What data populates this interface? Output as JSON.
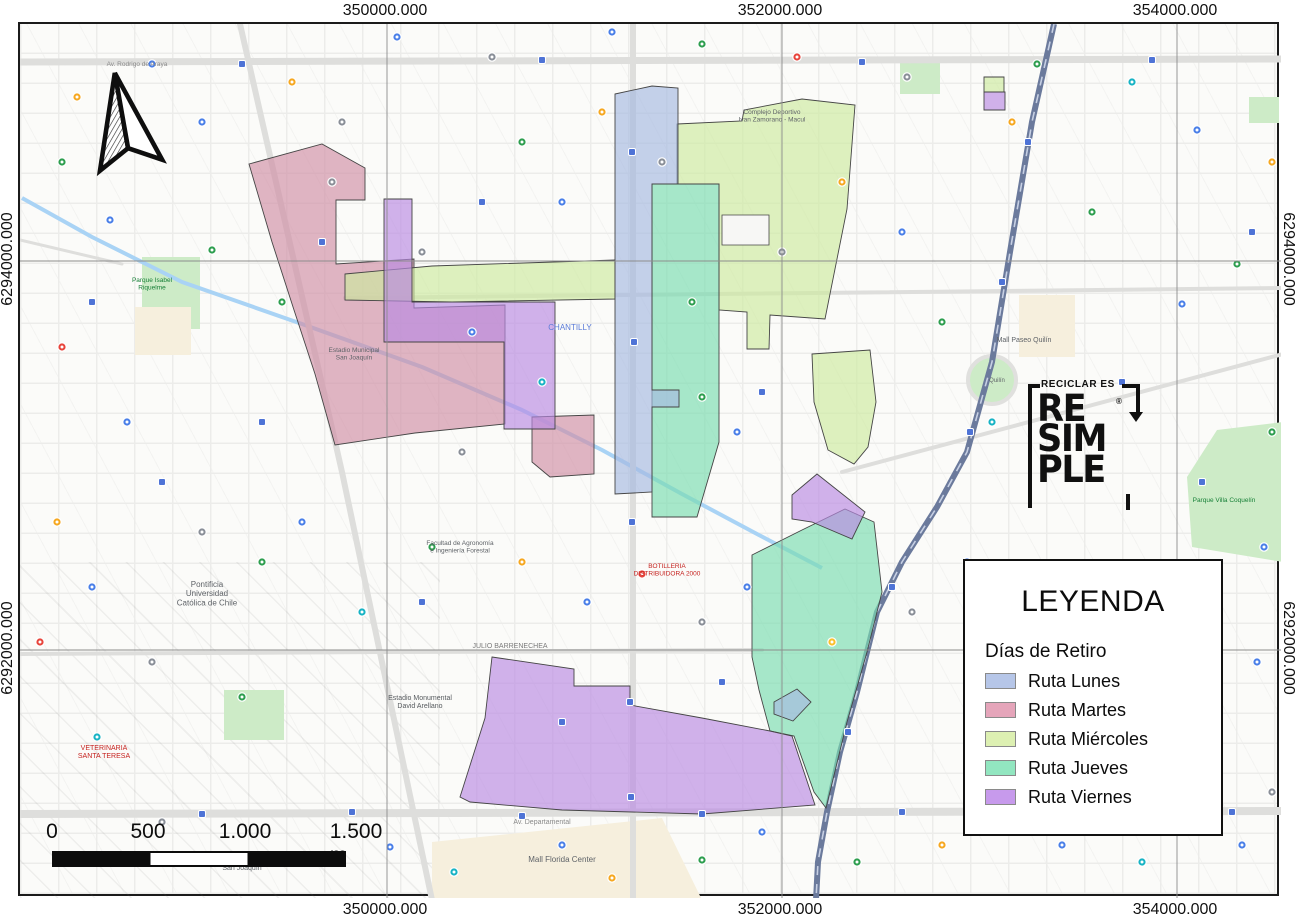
{
  "grid": {
    "x_ticks": [
      "350000.000",
      "352000.000",
      "354000.000"
    ],
    "y_ticks": [
      "6294000.000",
      "6292000.000"
    ]
  },
  "scalebar": {
    "labels": [
      "0",
      "500",
      "1.000",
      "1.500 m"
    ]
  },
  "legend": {
    "title": "LEYENDA",
    "subtitle": "Días de Retiro"
  },
  "logo": {
    "tagline": "RECICLAR ES",
    "lines": [
      "RE",
      "SIM",
      "PLE"
    ],
    "registered": "®"
  },
  "routes": [
    {
      "name": "Ruta Lunes",
      "legend_color": "#b6c6e8",
      "map_fill": "#a6b9e0",
      "polys": [
        "613,92 650,84 676,86 676,182 650,182 650,388 677,388 677,405 650,405 650,490 613,492",
        "772,700 795,687 809,700 791,719 772,712"
      ]
    },
    {
      "name": "Ruta Martes",
      "legend_color": "#e5a5ba",
      "map_fill": "#d08ea6",
      "polys": [
        "247,162 320,142 363,166 363,198 334,198 334,262 412,257 412,306 503,303 503,422 413,431 333,443 313,372 292,308 270,240",
        "530,415 592,413 592,472 548,475 530,460"
      ]
    },
    {
      "name": "Ruta Miércoles",
      "legend_color": "#ddf0b2",
      "map_fill": "#cde9a0",
      "polys": [
        "343,272 430,264 613,258 613,297 450,300 343,298",
        "675,122 740,119 742,108 800,97 853,103 845,207 837,247 823,317 768,313 767,347 745,347 745,310 717,308 717,182 675,182",
        "810,352 868,348 874,400 866,445 852,462 826,448 812,400",
        "982,75 1002,75 1002,90 982,90"
      ],
      "holes": [
        "720,213 767,213 767,243 720,243"
      ]
    },
    {
      "name": "Ruta Jueves",
      "legend_color": "#92e6c0",
      "map_fill": "#79dcb0",
      "polys": [
        "650,182 717,182 717,440 695,515 650,515",
        "750,553 800,528 843,507 872,520 880,590 865,650 845,720 824,806 812,790 792,734 768,729 757,688 750,655"
      ]
    },
    {
      "name": "Ruta Viernes",
      "legend_color": "#c79aec",
      "map_fill": "#b98ae2",
      "polys": [
        "382,197 410,197 410,300 553,300 553,427 502,427 502,340 382,340",
        "790,493 815,472 863,510 850,537 810,520 790,517",
        "490,655 572,667 572,684 628,684 628,703 700,716 768,729 790,734 813,803 700,812 560,808 468,800 458,795 483,716",
        "982,90 1003,90 1003,108 982,108"
      ]
    }
  ],
  "basemap": {
    "park_color": "#cdebc7",
    "cream_color": "#f6efdd",
    "canal_color": "#a9d3f5",
    "road_color": "#dededc",
    "railway_color": "#6b7a9c",
    "transit_color": "#4e73d6",
    "parks": [
      "140,255 198,255 198,327 140,327",
      "1185,475 1215,428 1281,420 1281,560 1190,545",
      "222,688 282,688 282,738 222,738",
      "898,58 938,58 938,92 898,92",
      "1247,95 1277,95 1277,121 1247,121"
    ],
    "park_circles": [
      [
        990,
        378,
        24
      ]
    ],
    "cream": [
      "430,840 660,816 700,898 430,898",
      "1017,293 1073,293 1073,355 1017,355",
      "133,305 189,305 189,353 133,353"
    ],
    "canal": "20,196 90,235 180,280 300,322 420,365 520,408 600,448 680,492 755,532 820,566",
    "roads": [
      {
        "pts": "18,60 1281,57",
        "w": 7
      },
      {
        "pts": "18,812 1281,809",
        "w": 8
      },
      {
        "pts": "631,22 631,898",
        "w": 6
      },
      {
        "pts": "238,22 340,470 430,898",
        "w": 6
      },
      {
        "pts": "343,296 1281,286",
        "w": 4
      },
      {
        "pts": "18,652 760,648",
        "w": 4
      },
      {
        "pts": "840,470 1281,352",
        "w": 4
      },
      {
        "pts": "18,238 120,262",
        "w": 3
      }
    ],
    "railway": "1052,22 1030,120 1008,250 990,360 965,450 935,505 900,560 875,610 855,690 838,750 825,810 816,860 814,898",
    "labels": [
      {
        "x": 205,
        "y": 585,
        "t": "Pontificia\nUniversidad\nCatólica de Chile",
        "c": "#5f6368",
        "s": 8
      },
      {
        "x": 418,
        "y": 698,
        "t": "Estadio Monumental\nDavid Arellano",
        "c": "#575b5f",
        "s": 7
      },
      {
        "x": 508,
        "y": 646,
        "t": "JULIO BARRENECHEA",
        "c": "#7a7a7a",
        "s": 7
      },
      {
        "x": 540,
        "y": 822,
        "t": "Av. Departamental",
        "c": "#8a8a8a",
        "s": 7
      },
      {
        "x": 560,
        "y": 860,
        "t": "Mall Florida Center",
        "c": "#5f6368",
        "s": 8
      },
      {
        "x": 1022,
        "y": 340,
        "t": "Mall Paseo Quilín",
        "c": "#5f6368",
        "s": 7
      },
      {
        "x": 568,
        "y": 328,
        "t": "CHANTILLY",
        "c": "#5a7bd8",
        "s": 8
      },
      {
        "x": 240,
        "y": 860,
        "t": "TEATRO Cultural\nSan Joaquín",
        "c": "#5f6368",
        "s": 7
      },
      {
        "x": 102,
        "y": 748,
        "t": "VETERINARIA\nSANTA TERESA",
        "c": "#c5221f",
        "s": 7
      },
      {
        "x": 665,
        "y": 566,
        "t": "BOTILLERIA\nDISTRIBUIDORA 2000",
        "c": "#c5221f",
        "s": 6.5
      },
      {
        "x": 770,
        "y": 112,
        "t": "Complejo Deportivo\nIvan Zamorano - Macul",
        "c": "#5f6368",
        "s": 6.5
      },
      {
        "x": 458,
        "y": 543,
        "t": "Facultad de Agronomía\ne Ingeniería Forestal",
        "c": "#5f6368",
        "s": 6.5
      },
      {
        "x": 1222,
        "y": 500,
        "t": "Parque Villa Coquelín",
        "c": "#188038",
        "s": 6.5
      },
      {
        "x": 352,
        "y": 350,
        "t": "Estadio Municipal\nSan Joaquín",
        "c": "#5f6368",
        "s": 6.5
      },
      {
        "x": 150,
        "y": 280,
        "t": "Parque Isabel\nRiquelme",
        "c": "#188038",
        "s": 6.5
      },
      {
        "x": 995,
        "y": 380,
        "t": "Quilín",
        "c": "#5f6368",
        "s": 6
      },
      {
        "x": 135,
        "y": 64,
        "t": "Av. Rodrigo de Araya",
        "c": "#8a8a8a",
        "s": 6.5
      }
    ],
    "pins": [
      [
        75,
        95,
        "#f6a821"
      ],
      [
        150,
        62,
        "#4a7fe8"
      ],
      [
        108,
        218,
        "#4a7fe8"
      ],
      [
        210,
        248,
        "#2e9e4f"
      ],
      [
        60,
        345,
        "#e8453c"
      ],
      [
        125,
        420,
        "#4a7fe8"
      ],
      [
        55,
        520,
        "#f6a821"
      ],
      [
        90,
        585,
        "#4a7fe8"
      ],
      [
        38,
        640,
        "#e8453c"
      ],
      [
        150,
        660,
        "#8a8f98"
      ],
      [
        240,
        695,
        "#2e9e4f"
      ],
      [
        95,
        735,
        "#18b3c4"
      ],
      [
        160,
        820,
        "#8a8f98"
      ],
      [
        310,
        858,
        "#2e9e4f"
      ],
      [
        388,
        845,
        "#4a7fe8"
      ],
      [
        452,
        870,
        "#18b3c4"
      ],
      [
        560,
        843,
        "#4a7fe8"
      ],
      [
        610,
        876,
        "#f6a821"
      ],
      [
        700,
        858,
        "#2e9e4f"
      ],
      [
        760,
        830,
        "#4a7fe8"
      ],
      [
        855,
        860,
        "#2e9e4f"
      ],
      [
        940,
        843,
        "#f6a821"
      ],
      [
        1060,
        843,
        "#4a7fe8"
      ],
      [
        1140,
        860,
        "#18b3c4"
      ],
      [
        1240,
        843,
        "#4a7fe8"
      ],
      [
        1270,
        790,
        "#8a8f98"
      ],
      [
        1180,
        720,
        "#2e9e4f"
      ],
      [
        1255,
        660,
        "#4a7fe8"
      ],
      [
        1205,
        592,
        "#8a8f98"
      ],
      [
        1262,
        545,
        "#4a7fe8"
      ],
      [
        1270,
        430,
        "#2e9e4f"
      ],
      [
        1180,
        302,
        "#4a7fe8"
      ],
      [
        1235,
        262,
        "#2e9e4f"
      ],
      [
        1270,
        160,
        "#f6a821"
      ],
      [
        1195,
        128,
        "#4a7fe8"
      ],
      [
        1130,
        80,
        "#18b3c4"
      ],
      [
        1035,
        62,
        "#2e9e4f"
      ],
      [
        905,
        75,
        "#8a8f98"
      ],
      [
        795,
        55,
        "#e8453c"
      ],
      [
        700,
        42,
        "#2e9e4f"
      ],
      [
        610,
        30,
        "#4a7fe8"
      ],
      [
        490,
        55,
        "#8a8f98"
      ],
      [
        395,
        35,
        "#4a7fe8"
      ],
      [
        290,
        80,
        "#f6a821"
      ],
      [
        330,
        180,
        "#8a8f98"
      ],
      [
        280,
        300,
        "#2e9e4f"
      ],
      [
        420,
        250,
        "#8a8f98"
      ],
      [
        470,
        330,
        "#4a7fe8"
      ],
      [
        540,
        380,
        "#18b3c4"
      ],
      [
        460,
        450,
        "#8a8f98"
      ],
      [
        430,
        545,
        "#2e9e4f"
      ],
      [
        520,
        560,
        "#f6a821"
      ],
      [
        585,
        600,
        "#4a7fe8"
      ],
      [
        640,
        572,
        "#e8453c"
      ],
      [
        700,
        620,
        "#8a8f98"
      ],
      [
        745,
        585,
        "#4a7fe8"
      ],
      [
        830,
        640,
        "#fbc02d"
      ],
      [
        910,
        610,
        "#8a8f98"
      ],
      [
        965,
        560,
        "#4a7fe8"
      ],
      [
        700,
        395,
        "#2e9e4f"
      ],
      [
        735,
        430,
        "#4a7fe8"
      ],
      [
        690,
        300,
        "#2e9e4f"
      ],
      [
        780,
        250,
        "#8a8f98"
      ],
      [
        840,
        180,
        "#f6a821"
      ],
      [
        900,
        230,
        "#4a7fe8"
      ],
      [
        940,
        320,
        "#2e9e4f"
      ],
      [
        990,
        420,
        "#18b3c4"
      ],
      [
        560,
        200,
        "#4a7fe8"
      ],
      [
        520,
        140,
        "#2e9e4f"
      ],
      [
        600,
        110,
        "#f6a821"
      ],
      [
        660,
        160,
        "#8a8f98"
      ],
      [
        300,
        520,
        "#4a7fe8"
      ],
      [
        360,
        610,
        "#18b3c4"
      ],
      [
        260,
        560,
        "#2e9e4f"
      ],
      [
        200,
        530,
        "#8a8f98"
      ],
      [
        60,
        160,
        "#2e9e4f"
      ],
      [
        200,
        120,
        "#4a7fe8"
      ],
      [
        340,
        120,
        "#8a8f98"
      ],
      [
        1090,
        210,
        "#2e9e4f"
      ],
      [
        1010,
        120,
        "#f6a821"
      ]
    ],
    "transit": [
      "240,62",
      "540,58",
      "860,60",
      "1150,58",
      "630,150",
      "632,340",
      "630,520",
      "628,700",
      "629,795",
      "200,812",
      "350,810",
      "520,814",
      "700,812",
      "900,810",
      "1080,812",
      "1230,810",
      "1026,140",
      "1000,280",
      "968,430",
      "890,585",
      "846,730",
      "90,300",
      "160,480",
      "420,600",
      "760,390",
      "980,640",
      "1200,480",
      "320,240",
      "480,200",
      "720,680",
      "560,720",
      "260,420",
      "1120,380",
      "1250,230"
    ]
  }
}
